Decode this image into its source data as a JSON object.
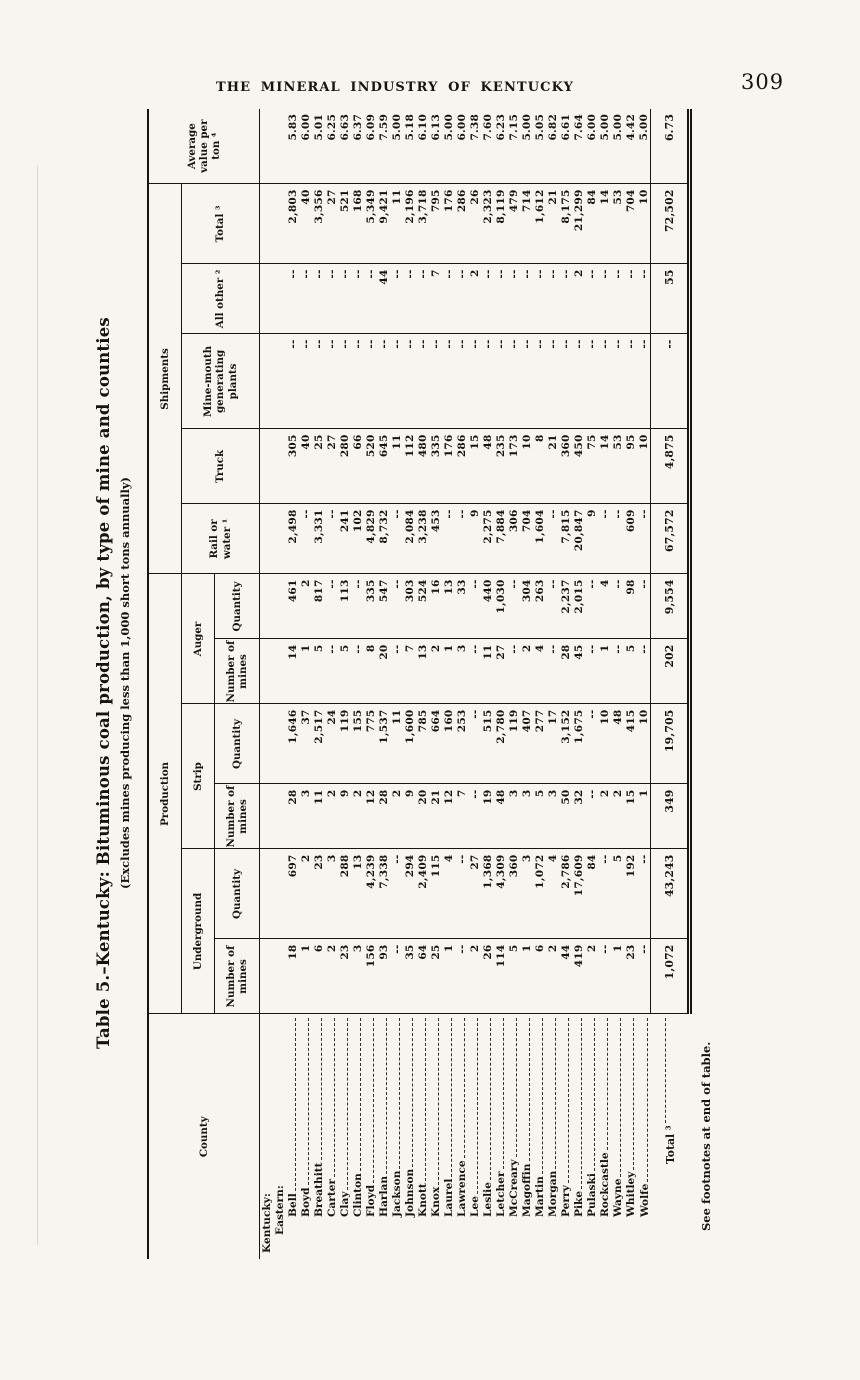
{
  "page": {
    "header": "THE MINERAL INDUSTRY OF KENTUCKY",
    "page_number": "309"
  },
  "colors": {
    "paper": "#f7f5ef",
    "ink": "#17130d"
  },
  "table": {
    "title": "Table 5.–Kentucky:  Bituminous coal production, by type of mine and counties",
    "subtitle": "(Excludes mines producing less than 1,000 short tons annually)",
    "footnote": "See footnotes at end of table.",
    "headers": {
      "county": "County",
      "production": "Production",
      "shipments": "Shipments",
      "underground": "Underground",
      "strip": "Strip",
      "auger": "Auger",
      "number_of_mines": "Number of mines",
      "quantity": "Quantity",
      "rail_or_water": "Rail or water ¹",
      "truck": "Truck",
      "mine_mouth": "Mine-mouth generating plants",
      "all_other": "All other ²",
      "total": "Total ³",
      "avg_value": "Average value per ton ⁴"
    },
    "rows": [
      {
        "label": "Kentucky:",
        "indent": 0,
        "leaders": false,
        "values": [
          "",
          "",
          "",
          "",
          "",
          "",
          "",
          "",
          "",
          "",
          "",
          ""
        ]
      },
      {
        "label": "Eastern:",
        "indent": 1,
        "leaders": false,
        "values": [
          "",
          "",
          "",
          "",
          "",
          "",
          "",
          "",
          "",
          "",
          "",
          ""
        ]
      },
      {
        "label": "Bell",
        "indent": 2,
        "leaders": true,
        "values": [
          "18",
          "697",
          "28",
          "1,646",
          "14",
          "461",
          "2,498",
          "305",
          "--",
          "--",
          "2,803",
          "5.83"
        ]
      },
      {
        "label": "Boyd",
        "indent": 2,
        "leaders": true,
        "values": [
          "1",
          "2",
          "3",
          "37",
          "1",
          "2",
          "--",
          "40",
          "--",
          "--",
          "40",
          "6.00"
        ]
      },
      {
        "label": "Breathitt",
        "indent": 2,
        "leaders": true,
        "values": [
          "6",
          "23",
          "11",
          "2,517",
          "5",
          "817",
          "3,331",
          "25",
          "--",
          "--",
          "3,356",
          "5.01"
        ]
      },
      {
        "label": "Carter",
        "indent": 2,
        "leaders": true,
        "values": [
          "2",
          "3",
          "2",
          "24",
          "--",
          "--",
          "--",
          "27",
          "--",
          "--",
          "27",
          "6.25"
        ]
      },
      {
        "label": "Clay",
        "indent": 2,
        "leaders": true,
        "values": [
          "23",
          "288",
          "9",
          "119",
          "5",
          "113",
          "241",
          "280",
          "--",
          "--",
          "521",
          "6.63"
        ]
      },
      {
        "label": "Clinton",
        "indent": 2,
        "leaders": true,
        "values": [
          "3",
          "13",
          "2",
          "155",
          "--",
          "--",
          "102",
          "66",
          "--",
          "--",
          "168",
          "6.37"
        ]
      },
      {
        "label": "Floyd",
        "indent": 2,
        "leaders": true,
        "values": [
          "156",
          "4,239",
          "12",
          "775",
          "8",
          "335",
          "4,829",
          "520",
          "--",
          "--",
          "5,349",
          "6.09"
        ]
      },
      {
        "label": "Harlan",
        "indent": 2,
        "leaders": true,
        "values": [
          "93",
          "7,338",
          "28",
          "1,537",
          "20",
          "547",
          "8,732",
          "645",
          "--",
          "44",
          "9,421",
          "7.59"
        ]
      },
      {
        "label": "Jackson",
        "indent": 2,
        "leaders": true,
        "values": [
          "--",
          "--",
          "2",
          "11",
          "--",
          "--",
          "--",
          "11",
          "--",
          "--",
          "11",
          "5.00"
        ]
      },
      {
        "label": "Johnson",
        "indent": 2,
        "leaders": true,
        "values": [
          "35",
          "294",
          "9",
          "1,600",
          "7",
          "303",
          "2,084",
          "112",
          "--",
          "--",
          "2,196",
          "5.18"
        ]
      },
      {
        "label": "Knott",
        "indent": 2,
        "leaders": true,
        "values": [
          "64",
          "2,409",
          "20",
          "785",
          "13",
          "524",
          "3,238",
          "480",
          "--",
          "--",
          "3,718",
          "6.10"
        ]
      },
      {
        "label": "Knox",
        "indent": 2,
        "leaders": true,
        "values": [
          "25",
          "115",
          "21",
          "664",
          "2",
          "16",
          "453",
          "335",
          "--",
          "7",
          "795",
          "6.13"
        ]
      },
      {
        "label": "Laurel",
        "indent": 2,
        "leaders": true,
        "values": [
          "1",
          "4",
          "12",
          "160",
          "1",
          "13",
          "--",
          "176",
          "--",
          "--",
          "176",
          "5.00"
        ]
      },
      {
        "label": "Lawrence",
        "indent": 2,
        "leaders": true,
        "values": [
          "--",
          "--",
          "7",
          "253",
          "3",
          "33",
          "--",
          "286",
          "--",
          "--",
          "286",
          "6.00"
        ]
      },
      {
        "label": "Lee",
        "indent": 2,
        "leaders": true,
        "values": [
          "2",
          "27",
          "--",
          "--",
          "--",
          "--",
          "9",
          "15",
          "--",
          "2",
          "26",
          "7.38"
        ]
      },
      {
        "label": "Leslie",
        "indent": 2,
        "leaders": true,
        "values": [
          "26",
          "1,368",
          "19",
          "515",
          "11",
          "440",
          "2,275",
          "48",
          "--",
          "--",
          "2,323",
          "7.60"
        ]
      },
      {
        "label": "Letcher",
        "indent": 2,
        "leaders": true,
        "values": [
          "114",
          "4,309",
          "48",
          "2,780",
          "27",
          "1,030",
          "7,884",
          "235",
          "--",
          "--",
          "8,119",
          "6.23"
        ]
      },
      {
        "label": "McCreary",
        "indent": 2,
        "leaders": true,
        "values": [
          "5",
          "360",
          "3",
          "119",
          "--",
          "--",
          "306",
          "173",
          "--",
          "--",
          "479",
          "7.15"
        ]
      },
      {
        "label": "Magoffin",
        "indent": 2,
        "leaders": true,
        "values": [
          "1",
          "3",
          "3",
          "407",
          "2",
          "304",
          "704",
          "10",
          "--",
          "--",
          "714",
          "5.00"
        ]
      },
      {
        "label": "Martin",
        "indent": 2,
        "leaders": true,
        "values": [
          "6",
          "1,072",
          "5",
          "277",
          "4",
          "263",
          "1,604",
          "8",
          "--",
          "--",
          "1,612",
          "5.05"
        ]
      },
      {
        "label": "Morgan",
        "indent": 2,
        "leaders": true,
        "values": [
          "2",
          "4",
          "3",
          "17",
          "--",
          "--",
          "--",
          "21",
          "--",
          "--",
          "21",
          "6.82"
        ]
      },
      {
        "label": "Perry",
        "indent": 2,
        "leaders": true,
        "values": [
          "44",
          "2,786",
          "50",
          "3,152",
          "28",
          "2,237",
          "7,815",
          "360",
          "--",
          "--",
          "8,175",
          "6.61"
        ]
      },
      {
        "label": "Pike",
        "indent": 2,
        "leaders": true,
        "values": [
          "419",
          "17,609",
          "32",
          "1,675",
          "45",
          "2,015",
          "20,847",
          "450",
          "--",
          "2",
          "21,299",
          "7.64"
        ]
      },
      {
        "label": "Pulaski",
        "indent": 2,
        "leaders": true,
        "values": [
          "2",
          "84",
          "--",
          "--",
          "--",
          "--",
          "9",
          "75",
          "--",
          "--",
          "84",
          "6.00"
        ]
      },
      {
        "label": "Rockcastle",
        "indent": 2,
        "leaders": true,
        "values": [
          "--",
          "--",
          "2",
          "10",
          "1",
          "4",
          "--",
          "14",
          "--",
          "--",
          "14",
          "5.00"
        ]
      },
      {
        "label": "Wayne",
        "indent": 2,
        "leaders": true,
        "values": [
          "1",
          "5",
          "2",
          "48",
          "--",
          "--",
          "--",
          "53",
          "--",
          "--",
          "53",
          "5.00"
        ]
      },
      {
        "label": "Whitley",
        "indent": 2,
        "leaders": true,
        "values": [
          "23",
          "192",
          "15",
          "415",
          "5",
          "98",
          "609",
          "95",
          "--",
          "--",
          "704",
          "4.42"
        ]
      },
      {
        "label": "Wolfe",
        "indent": 2,
        "leaders": true,
        "values": [
          "--",
          "--",
          "1",
          "10",
          "--",
          "--",
          "--",
          "10",
          "--",
          "--",
          "10",
          "5.00"
        ]
      }
    ],
    "total_row": {
      "label": "Total ³",
      "values": [
        "1,072",
        "43,243",
        "349",
        "19,705",
        "202",
        "9,554",
        "67,572",
        "4,875",
        "--",
        "55",
        "72,502",
        "6.73"
      ]
    }
  }
}
